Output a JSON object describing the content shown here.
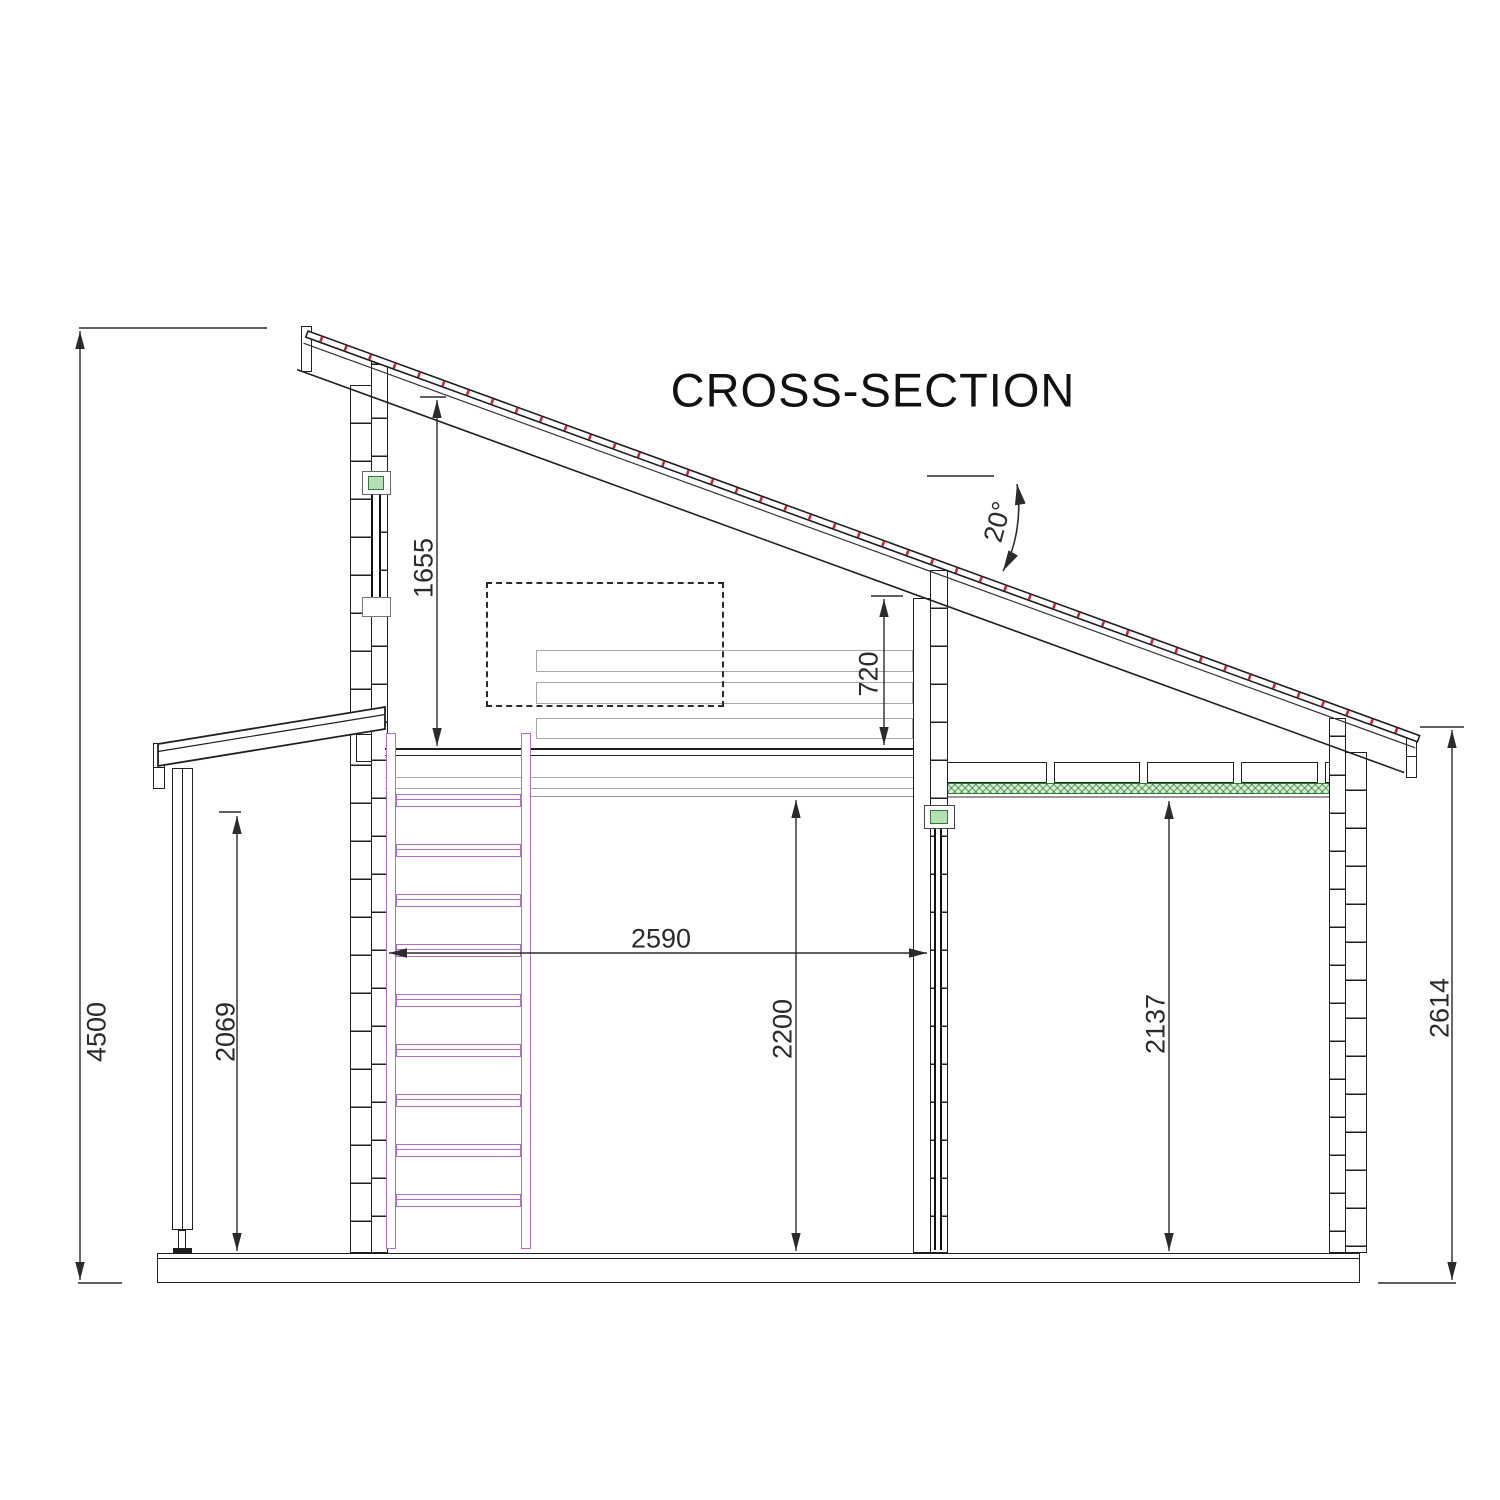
{
  "title": "CROSS-SECTION",
  "roof": {
    "angle_label": "20°",
    "angle_deg": 20
  },
  "dimensions": {
    "overall_height": {
      "value": "4500",
      "orientation": "vertical"
    },
    "roof_to_loft_floor": {
      "value": "1655",
      "orientation": "vertical"
    },
    "loft_clearance": {
      "value": "720",
      "orientation": "vertical"
    },
    "porch_height": {
      "value": "2069",
      "orientation": "vertical"
    },
    "loft_width": {
      "value": "2590",
      "orientation": "horizontal"
    },
    "main_room_height": {
      "value": "2200",
      "orientation": "vertical"
    },
    "right_room_height": {
      "value": "2137",
      "orientation": "vertical"
    },
    "right_wall_height": {
      "value": "2614",
      "orientation": "vertical"
    }
  },
  "colors": {
    "line": "#1f1f1f",
    "dimension": "#2b2b2b",
    "ladder_purple": "#b06ec4",
    "insulation_green": "#2e7d32",
    "roof_fastener_red": "#cc2233",
    "plank_gray": "#a6a6a6"
  }
}
